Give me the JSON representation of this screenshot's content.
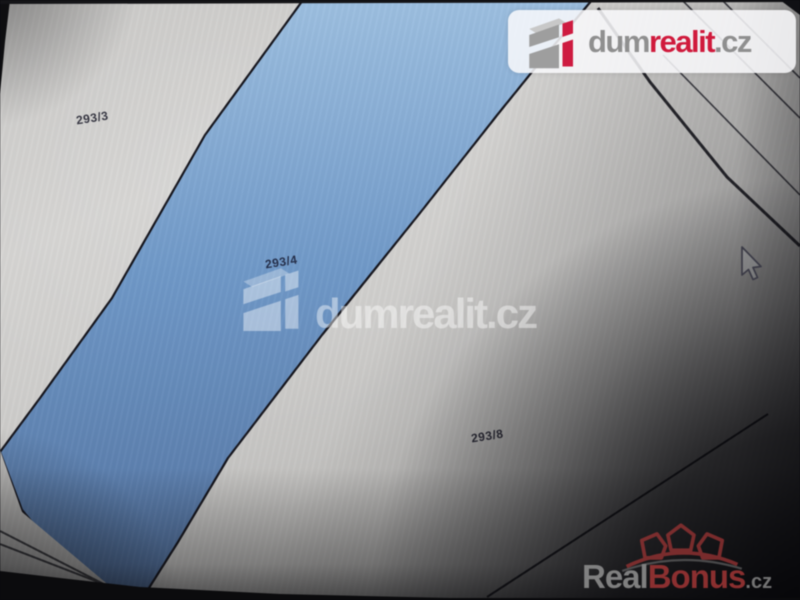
{
  "parcels": [
    {
      "label": "293/3"
    },
    {
      "label": "293/4"
    },
    {
      "label": "293/8"
    }
  ],
  "watermarks": {
    "center_brand": "dumrealit.cz",
    "top_right_logo": {
      "dum": "dum",
      "realit": "realit",
      "tld": ".cz"
    },
    "bottom_right_logo": {
      "real": "Real",
      "bonus": "Bonus",
      "tld": ".cz"
    }
  },
  "colors": {
    "highlighted_parcel_blue": "#7099c8",
    "dumrealit_red": "#d01a3c",
    "dumrealit_gray": "#8f8f8f",
    "realbonus_red": "#9c3434",
    "realbonus_gray": "#8e8e8e",
    "boundary_line": "#1a1a22"
  }
}
